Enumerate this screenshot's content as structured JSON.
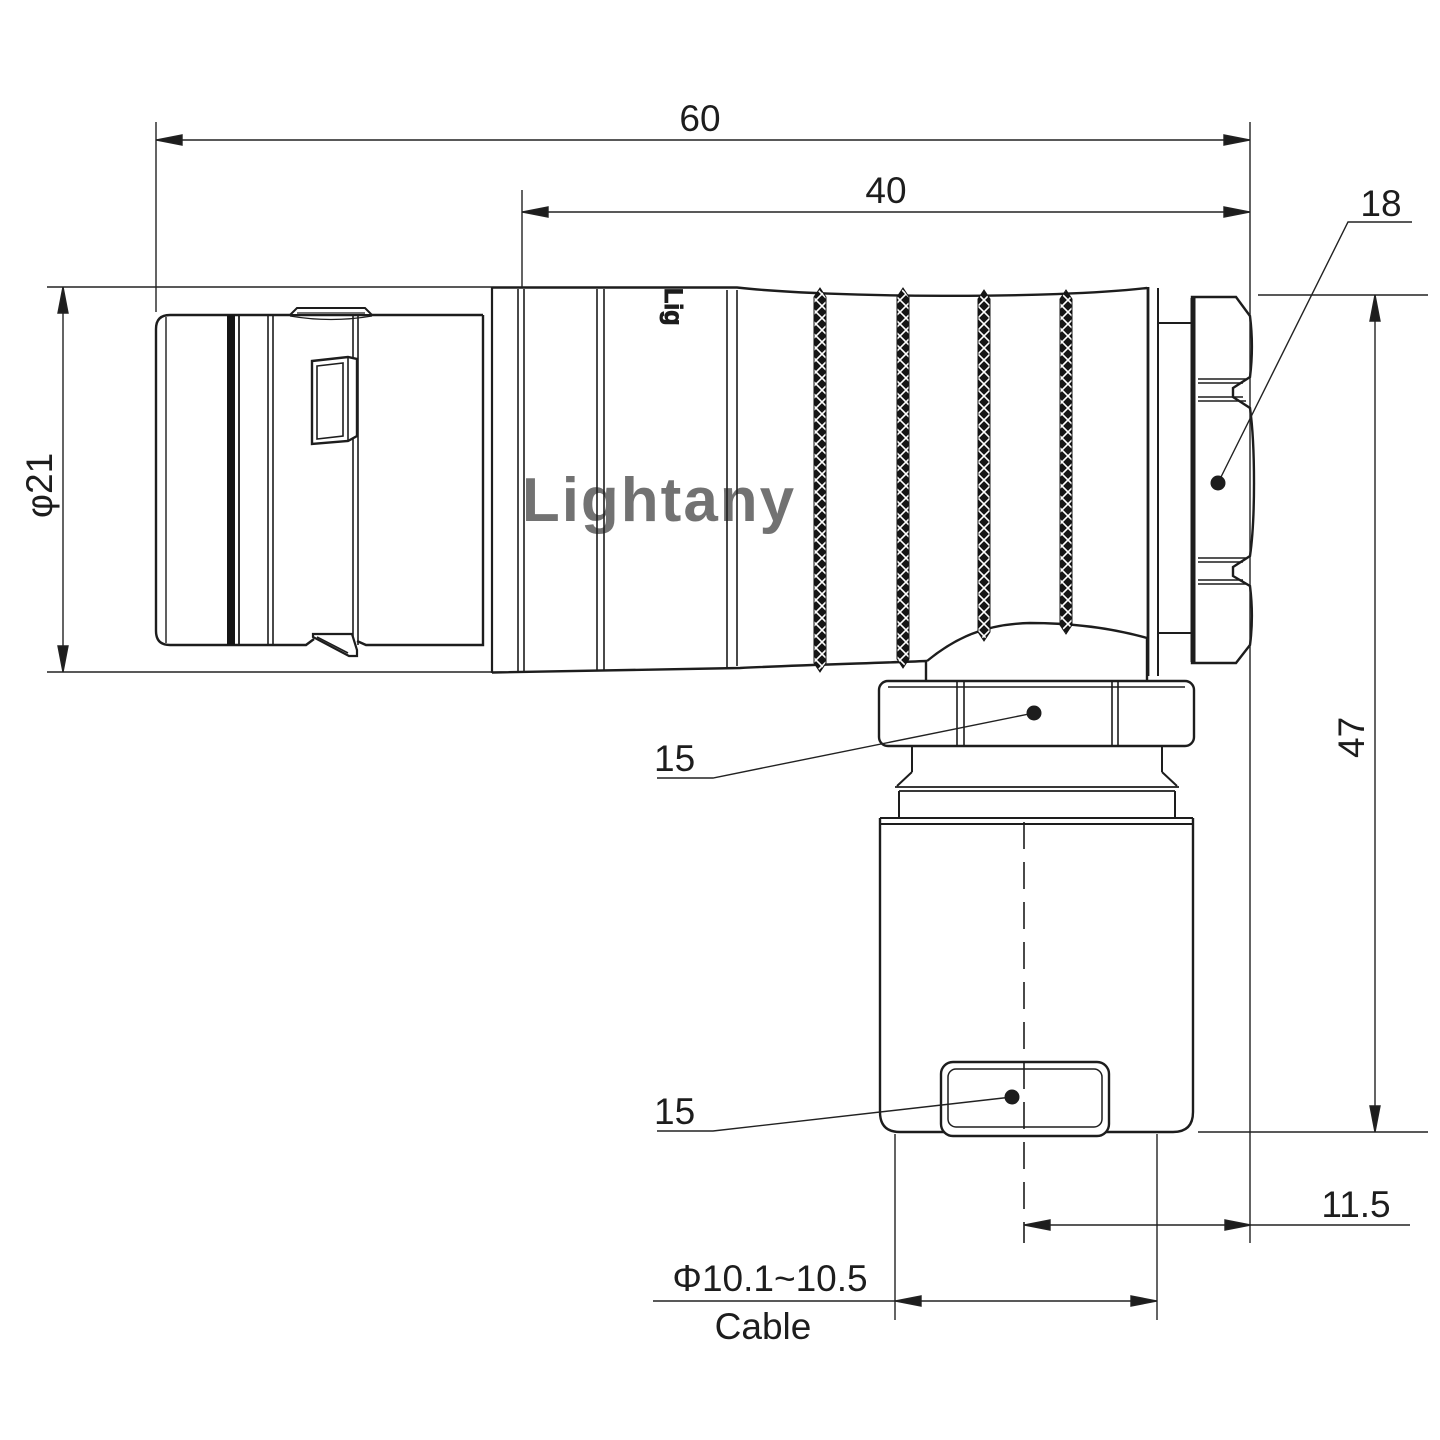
{
  "drawing": {
    "title_hint": "right-angle circular connector technical drawing",
    "watermark_text": "Lightany",
    "body_brand_text": "Lig",
    "dims": {
      "overall_length": "60",
      "rear_length": "40",
      "backnut_ref": "18",
      "front_diameter": "φ21",
      "overall_height": "47",
      "hex_nut_ref": "15",
      "cable_clamp_ref": "15",
      "cable_offset": "11.5",
      "cable_diameter_range": "Φ10.1~10.5",
      "cable_word": "Cable"
    },
    "colors": {
      "line": "#1d1d1d",
      "watermark": "#f5caca",
      "background": "#ffffff"
    }
  }
}
